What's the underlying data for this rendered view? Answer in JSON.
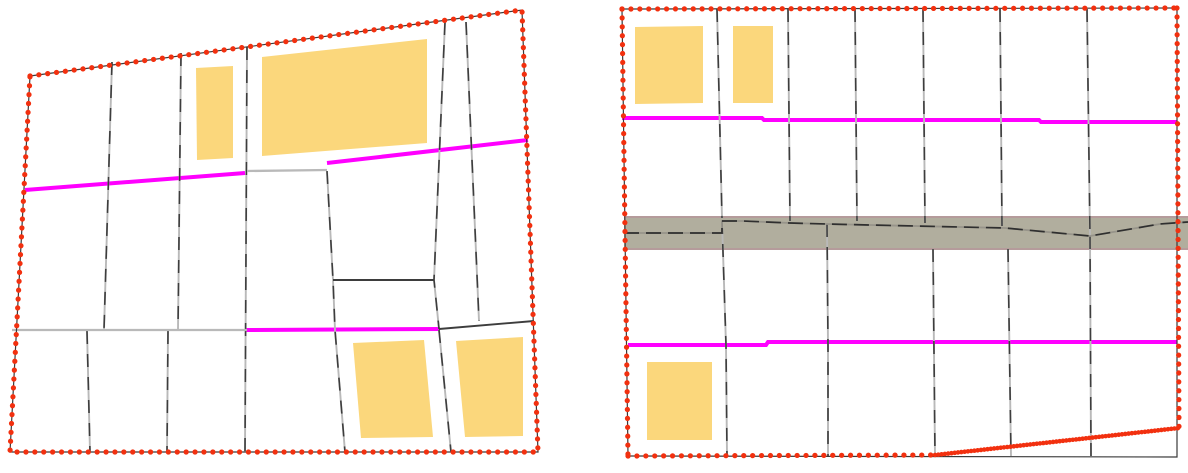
{
  "canvas": {
    "width": 1188,
    "height": 473,
    "background": "#ffffff"
  },
  "colors": {
    "background": "#ffffff",
    "boundary_dot_red": "#f2300f",
    "boundary_underlay_dark": "#3a3a3a",
    "parcel_line_dark": "#3d3d3d",
    "parcel_line_light": "#b9b9b9",
    "road_magenta": "#ff00ff",
    "building_fill": "#fbd77c",
    "strip_fill": "#b1ae9e",
    "strip_edge": "#b59b9b",
    "strip_inner_base": "#97948a"
  },
  "panels": [
    {
      "name": "left-parcel-map",
      "frame": [
        [
          30,
          76
        ],
        [
          522,
          10
        ],
        [
          538,
          452
        ],
        [
          10,
          452
        ]
      ],
      "boundary_segments": [
        {
          "dash": "dots",
          "points": [
            [
              30,
              76
            ],
            [
              522,
              10
            ],
            [
              538,
              452
            ],
            [
              10,
              452
            ],
            [
              30,
              76
            ]
          ]
        }
      ],
      "buildings": [
        [
          [
            196,
            68
          ],
          [
            233,
            66
          ],
          [
            233,
            158
          ],
          [
            197,
            160
          ]
        ],
        [
          [
            262,
            57
          ],
          [
            427,
            39
          ],
          [
            427,
            143
          ],
          [
            262,
            156
          ]
        ],
        [
          [
            353,
            343
          ],
          [
            424,
            340
          ],
          [
            433,
            437
          ],
          [
            361,
            438
          ]
        ],
        [
          [
            456,
            341
          ],
          [
            523,
            337
          ],
          [
            523,
            436
          ],
          [
            465,
            437
          ]
        ]
      ],
      "roads": [
        {
          "points": [
            [
              25,
              190
            ],
            [
              245,
              173
            ]
          ],
          "width": 4
        },
        {
          "points": [
            [
              327,
              163
            ],
            [
              528,
              140
            ]
          ],
          "width": 4
        },
        {
          "points": [
            [
              245,
              330
            ],
            [
              440,
              329
            ]
          ],
          "width": 4
        }
      ],
      "parcel_lines": [
        {
          "style": "dual",
          "points": [
            [
              112,
              62
            ],
            [
              104,
              330
            ]
          ]
        },
        {
          "style": "dual",
          "points": [
            [
              181,
              53
            ],
            [
              178,
              330
            ]
          ]
        },
        {
          "style": "dual",
          "points": [
            [
              247,
              47
            ],
            [
              245,
              452
            ]
          ]
        },
        {
          "style": "dual",
          "points": [
            [
              445,
              22
            ],
            [
              434,
              280
            ],
            [
              439,
              329
            ]
          ]
        },
        {
          "style": "dual",
          "points": [
            [
              466,
              22
            ],
            [
              479,
              321
            ]
          ]
        },
        {
          "style": "dual",
          "points": [
            [
              327,
              171
            ],
            [
              333,
              280
            ],
            [
              335,
              330
            ],
            [
              345,
              452
            ]
          ]
        },
        {
          "style": "dual",
          "points": [
            [
              439,
              330
            ],
            [
              451,
              452
            ]
          ]
        },
        {
          "style": "dual",
          "points": [
            [
              87,
              331
            ],
            [
              90,
              452
            ]
          ]
        },
        {
          "style": "dual",
          "points": [
            [
              168,
              331
            ],
            [
              167,
              452
            ]
          ]
        },
        {
          "style": "dark",
          "points": [
            [
              333,
              280
            ],
            [
              434,
              280
            ]
          ]
        },
        {
          "style": "dark",
          "points": [
            [
              439,
              329
            ],
            [
              534,
              321
            ]
          ]
        },
        {
          "style": "light",
          "points": [
            [
              12,
              330
            ],
            [
              247,
              330
            ]
          ]
        },
        {
          "style": "light",
          "points": [
            [
              247,
              171
            ],
            [
              327,
              170
            ]
          ]
        }
      ]
    },
    {
      "name": "right-parcel-map",
      "frame": [
        [
          622,
          9
        ],
        [
          1177,
          8
        ],
        [
          1177,
          457
        ],
        [
          628,
          456
        ]
      ],
      "boundary_segments": [
        {
          "dash": "dots",
          "points": [
            [
              622,
              9
            ],
            [
              1177,
              8
            ]
          ]
        },
        {
          "dash": "dots",
          "points": [
            [
              1177,
              8
            ],
            [
              1179,
              428
            ]
          ]
        },
        {
          "dash": "dots",
          "points": [
            [
              622,
              9
            ],
            [
              628,
              456
            ]
          ]
        },
        {
          "dash": "dots",
          "points": [
            [
              628,
              456
            ],
            [
              935,
              455
            ]
          ]
        },
        {
          "dash": "dense",
          "points": [
            [
              935,
              455
            ],
            [
              1179,
              428
            ]
          ]
        }
      ],
      "strip": {
        "fill_polygon": [
          [
            624,
            217
          ],
          [
            1188,
            217
          ],
          [
            1188,
            249
          ],
          [
            624,
            249
          ]
        ],
        "top_edge": [
          [
            624,
            217
          ],
          [
            1188,
            217
          ]
        ],
        "bottom_edge": [
          [
            624,
            249
          ],
          [
            1188,
            249
          ]
        ],
        "inner_line": [
          [
            624,
            233
          ],
          [
            722,
            233
          ],
          [
            722,
            221
          ],
          [
            743,
            221
          ],
          [
            790,
            223
          ],
          [
            827,
            224
          ],
          [
            870,
            225
          ],
          [
            1005,
            228
          ],
          [
            1090,
            236
          ],
          [
            1160,
            224
          ],
          [
            1188,
            222
          ]
        ]
      },
      "buildings": [
        [
          [
            635,
            27
          ],
          [
            703,
            26
          ],
          [
            703,
            103
          ],
          [
            635,
            104
          ]
        ],
        [
          [
            733,
            26
          ],
          [
            773,
            26
          ],
          [
            773,
            103
          ],
          [
            733,
            103
          ]
        ],
        [
          [
            647,
            362
          ],
          [
            712,
            362
          ],
          [
            712,
            440
          ],
          [
            647,
            440
          ]
        ]
      ],
      "roads": [
        {
          "points": [
            [
              622,
              118
            ],
            [
              762,
              118
            ],
            [
              764,
              120
            ],
            [
              1039,
              120
            ],
            [
              1041,
              122
            ],
            [
              1177,
              122
            ]
          ],
          "width": 4
        },
        {
          "points": [
            [
              628,
              345
            ],
            [
              766,
              345
            ],
            [
              768,
              342
            ],
            [
              1177,
              342
            ]
          ],
          "width": 4
        }
      ],
      "parcel_lines": [
        {
          "style": "dual",
          "points": [
            [
              717,
              9
            ],
            [
              722,
              218
            ]
          ]
        },
        {
          "style": "dual",
          "points": [
            [
              788,
              9
            ],
            [
              790,
              221
            ]
          ]
        },
        {
          "style": "dual",
          "points": [
            [
              855,
              9
            ],
            [
              857,
              221
            ]
          ]
        },
        {
          "style": "dual",
          "points": [
            [
              923,
              9
            ],
            [
              925,
              223
            ]
          ]
        },
        {
          "style": "dual",
          "points": [
            [
              1000,
              9
            ],
            [
              1002,
              226
            ]
          ]
        },
        {
          "style": "dual",
          "points": [
            [
              1087,
              9
            ],
            [
              1090,
              236
            ]
          ]
        },
        {
          "style": "dual",
          "points": [
            [
              722,
              221
            ],
            [
              726,
              345
            ],
            [
              727,
              456
            ]
          ]
        },
        {
          "style": "dual",
          "points": [
            [
              827,
              224
            ],
            [
              828,
              345
            ],
            [
              828,
              456
            ]
          ]
        },
        {
          "style": "dual",
          "points": [
            [
              933,
              249
            ],
            [
              935,
              456
            ]
          ]
        },
        {
          "style": "dual",
          "points": [
            [
              1008,
              249
            ],
            [
              1011,
              456
            ]
          ]
        },
        {
          "style": "dual",
          "points": [
            [
              1090,
              236
            ],
            [
              1091,
              456
            ]
          ]
        }
      ]
    }
  ]
}
